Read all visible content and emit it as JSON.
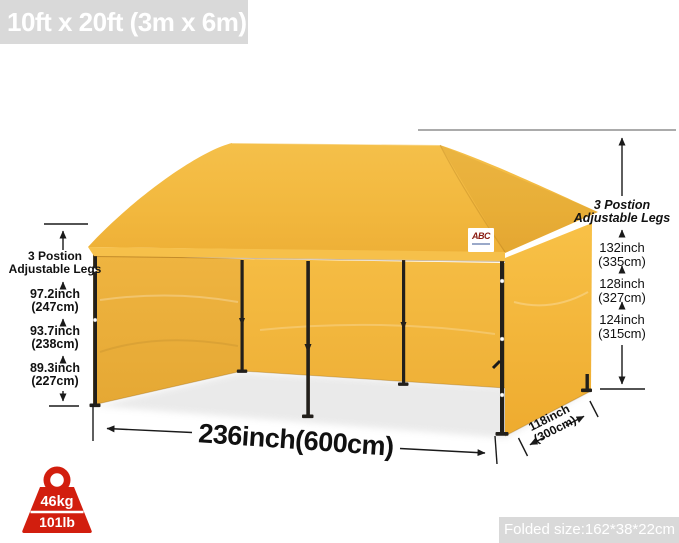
{
  "banner_top": {
    "label": "10ft x 20ft (3m x 6m)"
  },
  "banner_bottom": {
    "label": "Folded size:162*38*22cm"
  },
  "logo": {
    "text": "ABC"
  },
  "weight_badge": {
    "kg": "46kg",
    "lb": "101lb"
  },
  "left_dimension": {
    "header_line1": "3 Postion",
    "header_line2": "Adjustable Legs",
    "measurements": [
      {
        "inch": "97.2inch",
        "cm": "(247cm)"
      },
      {
        "inch": "93.7inch",
        "cm": "(238cm)"
      },
      {
        "inch": "89.3inch",
        "cm": "(227cm)"
      }
    ]
  },
  "right_dimension": {
    "header_line1": "3 Postion",
    "header_line2": "Adjustable Legs",
    "measurements": [
      {
        "inch": "132inch",
        "cm": "(335cm)"
      },
      {
        "inch": "128inch",
        "cm": "(327cm)"
      },
      {
        "inch": "124inch",
        "cm": "(315cm)"
      }
    ]
  },
  "width_dimension": {
    "label": "236inch(600cm)"
  },
  "depth_dimension": {
    "line1": "118inch",
    "line2": "(300cm)"
  },
  "colors": {
    "canopy_yellow": "#f2b83e",
    "badge_red": "#d21e0e",
    "banner_gray": "#d9d9d9",
    "annotation_black": "#1a1a1a"
  }
}
